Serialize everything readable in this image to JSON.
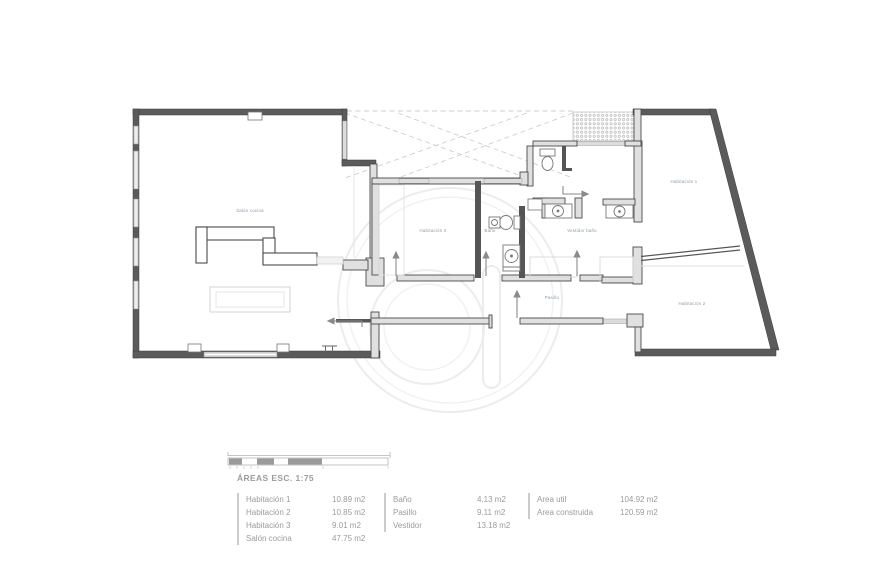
{
  "plan": {
    "labels": {
      "salon": "Salón cocina",
      "hab3": "Habitación 3",
      "bano": "Baño",
      "vestidor": "Vestidor baño",
      "pasillo": "Pasillo",
      "hab1": "Habitación 1",
      "hab2": "Habitación 2"
    }
  },
  "legend": {
    "title": "ÁREAS ESC. 1:75",
    "groups": [
      {
        "rows": [
          {
            "label": "Habitación 1",
            "value": "10.89 m2"
          },
          {
            "label": "Habitación 2",
            "value": "10.85 m2"
          },
          {
            "label": "Habitación 3",
            "value": "9.01 m2"
          },
          {
            "label": "Salón cocina",
            "value": "47.75 m2"
          }
        ]
      },
      {
        "rows": [
          {
            "label": "Baño",
            "value": "4.13 m2"
          },
          {
            "label": "Pasillo",
            "value": "9.11 m2"
          },
          {
            "label": "Vestidor",
            "value": "13.18 m2"
          }
        ]
      },
      {
        "rows": [
          {
            "label": "Area util",
            "value": "104.92 m2"
          },
          {
            "label": "Area construida",
            "value": "120.59 m2"
          }
        ]
      }
    ]
  },
  "colors": {
    "wall": "#5b5b5b",
    "interior_wall_fill": "#e0e0e0",
    "window": "#dcdcdc",
    "legend_text": "#9b9b9b",
    "plan_label": "#8f97a0",
    "watermark": "#ececec",
    "hatch_dots": "#b5b5b5",
    "background": "#ffffff"
  }
}
